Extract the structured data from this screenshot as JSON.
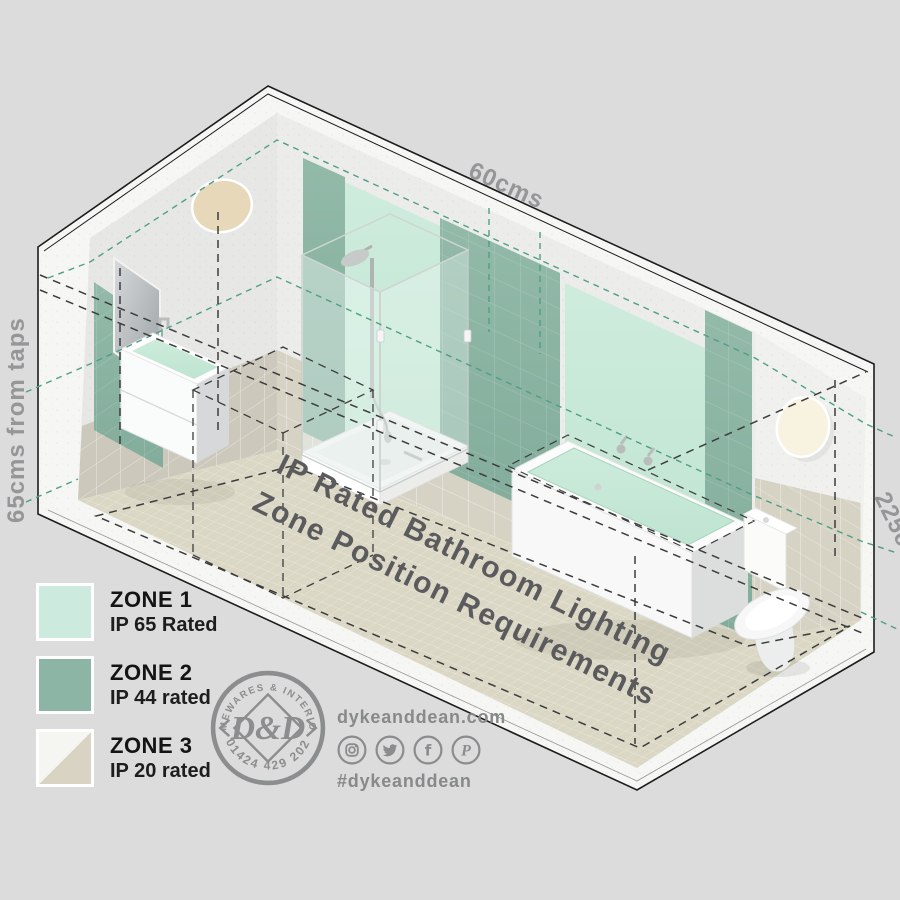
{
  "scene": {
    "title": {
      "line1": "IP Rated Bathroom Lighting",
      "line2": "Zone Position Requirements"
    },
    "dimensions": {
      "width_label": "60cms",
      "taps_label": "65cms from taps",
      "height_label": "225cms"
    },
    "room_items": [
      "mirror",
      "basin-vanity",
      "shower-enclosure",
      "bathtub",
      "toilet",
      "wall-light-left",
      "wall-light-right"
    ]
  },
  "legend": {
    "items": [
      {
        "zone": "ZONE 1",
        "rating": "IP 65 Rated",
        "color": "#cdeade"
      },
      {
        "zone": "ZONE 2",
        "rating": "IP 44 rated",
        "color": "#8db5a5"
      },
      {
        "zone": "ZONE 3",
        "rating": "IP 20 rated",
        "color_top": "#f5f5f1",
        "color_bottom": "#d9d3c4"
      }
    ]
  },
  "branding": {
    "badge": {
      "arc_top": "HOMEWARES & INTERIORS",
      "monogram": "D&D",
      "phone": "01424 429 202"
    },
    "website": "dykeanddean.com",
    "hashtag": "#dykeanddean",
    "social": [
      {
        "name": "instagram"
      },
      {
        "name": "twitter"
      },
      {
        "name": "facebook",
        "glyph": "f"
      },
      {
        "name": "pinterest",
        "glyph": "P"
      }
    ]
  },
  "colors": {
    "background": "#dbdcdb",
    "slab_white": "#f6f6f4",
    "concrete": "#ecedeb",
    "tile_beige": "#d6d2c4",
    "floor_beige": "#dbd7c5",
    "zone1_mint": "#c8e9d9",
    "zone2_green": "#8db5a5",
    "teal_dash": "#4f9f86",
    "black_dash": "#3c3c3c",
    "label_gray": "#949698",
    "title_gray": "#5b5b5d",
    "brand_gray": "#87898a"
  }
}
